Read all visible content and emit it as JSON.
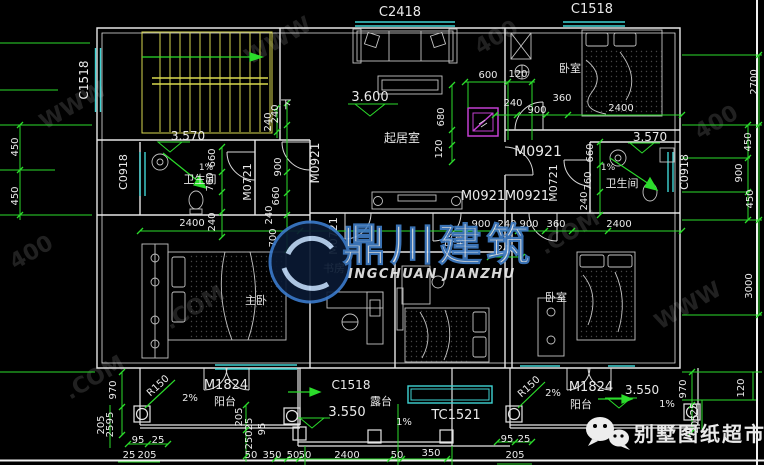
{
  "ann": {
    "c2418": "C2418",
    "c1518_top": "C1518",
    "c1518_left": "C1518",
    "c1518_bottom": "C1518",
    "c0918_left": "C0918",
    "c0918_right": "C0918",
    "tc1521": "TC1521",
    "m0921_living": "M0921",
    "m0921_center": "M0921",
    "m0921_a": "M0921",
    "m0921_b": "M0921",
    "m0721_bathl": "M0721",
    "m0721_study": "M0721",
    "m0721_bathr": "M0721",
    "m1824_left": "M1824",
    "m1824_right": "M1824",
    "living": "起居室",
    "bath_left": "卫生间",
    "bath_right": "卫生间",
    "bed_top_right": "卧室",
    "bed_center": "卧室",
    "bed_right": "卧室",
    "master": "主卧",
    "study": "书房",
    "balcony_left": "阳台",
    "balcony_right": "阳台",
    "terrace": "露台",
    "stair_down": "下",
    "lv3600": "3.600",
    "lv3570l": "3.570",
    "lv3570r": "3.570",
    "lv3550c": "3.550",
    "lv3550r": "3.550",
    "s1a": "1%",
    "s1b": "1%",
    "s1c": "1%",
    "s1d": "1%",
    "s2a": "2%",
    "s2b": "2%",
    "r150a": "R150",
    "r150b": "R150",
    "d600": "600",
    "d120t": "120",
    "d240t": "240",
    "d900t": "900",
    "d360t": "360",
    "d2400t": "2400",
    "d450l1": "450",
    "d450l2": "450",
    "d240st": "240",
    "dc240a": "240",
    "dc900": "900",
    "dc660": "660",
    "dc240b": "240",
    "dc700": "700",
    "db660": "660",
    "db760": "760",
    "db240": "240",
    "db2400": "2400",
    "dv680": "680",
    "dv120": "120",
    "dm900a": "900",
    "dm240a": "240",
    "dm900b": "900",
    "dm360": "360",
    "dm2400": "2400",
    "dm240b": "240",
    "dr660": "660",
    "dr760": "760",
    "dr240": "240",
    "dre450a": "450",
    "dre900": "900",
    "dre450b": "450",
    "dre2700": "2700",
    "dre3000": "3000",
    "dre120": "120",
    "dre970": "970",
    "dbl970": "970",
    "dbl205a": "205",
    "dbl95a": "95",
    "dbl25a": "25",
    "dbl95b": "95",
    "dbl25b": "25",
    "dbl25c": "25",
    "dbl205b": "205",
    "dbl205c": "205",
    "dbl25d": "25",
    "dbl250": "250",
    "dbl95c": "95",
    "dbl50": "50",
    "dbl350": "350",
    "dbc50a": "50",
    "dbc50b": "50",
    "dbc2400": "2400",
    "dbc50c": "50",
    "dbc350": "350",
    "dbc95": "95",
    "dbc25": "25",
    "dbc205": "205",
    "dbr25": "25",
    "dbr205": "205"
  },
  "wm": {
    "logo_cn": "鼎川建筑",
    "logo_en": "INGCHUAN JIANZHU",
    "shop": "别墅图纸超市",
    "pat1": "WWW",
    "pat2": "400",
    "pat3": ".COM"
  },
  "colors": {
    "wall": "#e6e6e6",
    "dimension": "#2bdc2b",
    "window": "#3fd4d4",
    "stairs": "#d9d94f",
    "flue": "#c23fd1",
    "logo_blue": "#0d3066",
    "shop_text": "#d9d9d9"
  }
}
